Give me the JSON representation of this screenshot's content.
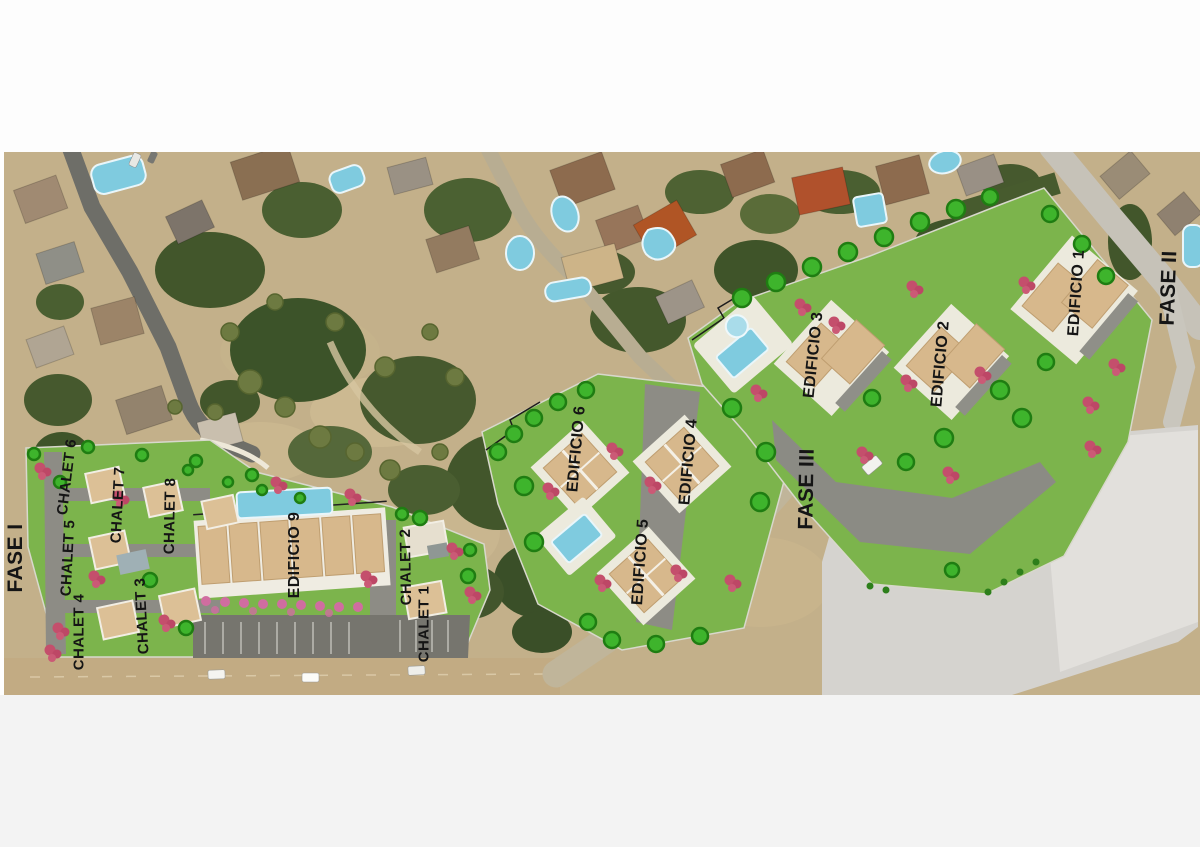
{
  "site_plan": {
    "title": "Aerial development site plan",
    "labels": [
      {
        "id": "fase-i",
        "text": "FASE I"
      },
      {
        "id": "fase-ii",
        "text": "FASE II"
      },
      {
        "id": "fase-iii",
        "text": "FASE III"
      },
      {
        "id": "chalet-1",
        "text": "CHALET 1"
      },
      {
        "id": "chalet-2",
        "text": "CHALET 2"
      },
      {
        "id": "chalet-3",
        "text": "CHALET 3"
      },
      {
        "id": "chalet-4",
        "text": "CHALET 4"
      },
      {
        "id": "chalet-5",
        "text": "CHALET 5"
      },
      {
        "id": "chalet-6",
        "text": "CHALET 6"
      },
      {
        "id": "chalet-7",
        "text": "CHALET 7"
      },
      {
        "id": "chalet-8",
        "text": "CHALET 8"
      },
      {
        "id": "edificio-1",
        "text": "EDIFICIO 1"
      },
      {
        "id": "edificio-2",
        "text": "EDIFICIO 2"
      },
      {
        "id": "edificio-3",
        "text": "EDIFICIO 3"
      },
      {
        "id": "edificio-4",
        "text": "EDIFICIO 4"
      },
      {
        "id": "edificio-5",
        "text": "EDIFICIO 5"
      },
      {
        "id": "edificio-6",
        "text": "EDIFICIO 6"
      },
      {
        "id": "edificio-9",
        "text": "EDIFICIO 9"
      }
    ],
    "palette": {
      "lawn_green": "#7cb44c",
      "scrub_beige": "#c3b08a",
      "dirt_road": "#c2ab83",
      "asphalt_dark": "#6e6e68",
      "road_light": "#c6c2b8",
      "empty_plot_gray": "#d5d3cf",
      "building_tan": "#d7b88c",
      "building_pad_white": "#eceadd",
      "pool_cyan": "#7fcbdf",
      "tree_canopy_dark": "#42562b",
      "tree_bright_green": "#3eb42c",
      "tree_pink": "#c44f6c",
      "label_color": "#151515"
    }
  }
}
